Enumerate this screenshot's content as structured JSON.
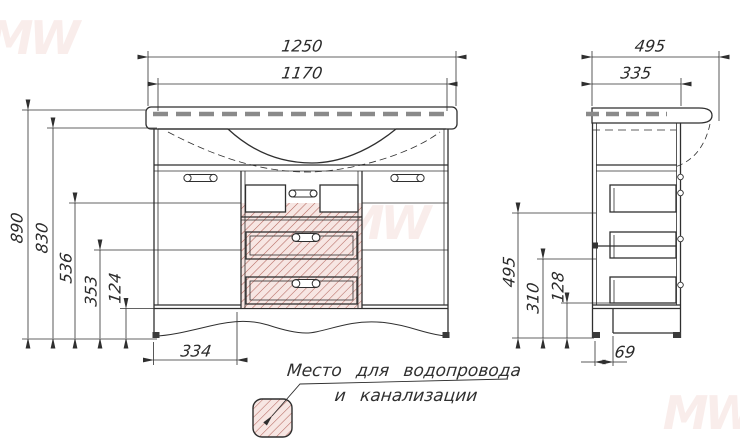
{
  "drawing": {
    "watermark_text": "MW",
    "front_view": {
      "dim_countertop_width": "1250",
      "dim_cabinet_width": "1170",
      "dim_total_height": "890",
      "dim_cabinet_height": "830",
      "dim_zone_top_height": "536",
      "dim_zone_mid_height": "353",
      "dim_zone_low_height": "124",
      "dim_door_width": "334"
    },
    "side_view": {
      "dim_countertop_depth": "495",
      "dim_cabinet_depth": "335",
      "dim_drawer_top_level": "495",
      "dim_drawer_mid_level": "310",
      "dim_drawer_low_level": "128",
      "dim_plinth_inset": "69"
    },
    "legend": {
      "label_line1": "Место для водопровода",
      "label_line2": "и канализации"
    },
    "colors": {
      "line": "#2f2f2f",
      "hatch_line": "#b5685f",
      "hatch_fill": "#f7e6e3",
      "countertop_dash": "#8a8a8a",
      "watermark": "#dc8c80"
    }
  }
}
